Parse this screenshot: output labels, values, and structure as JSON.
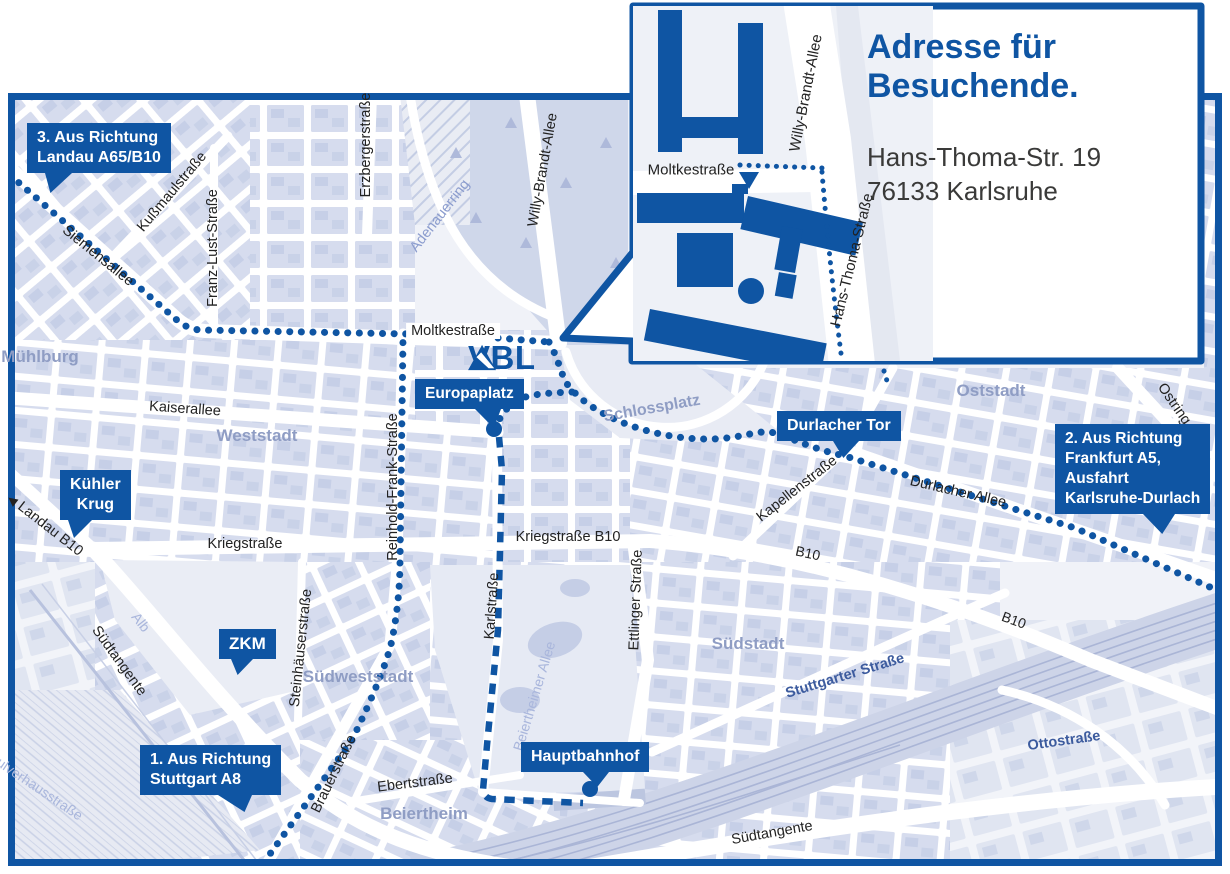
{
  "colors": {
    "primary_blue": "#0f55a3",
    "district_gray": "#8f9dc4",
    "light_street_blue": "#a9b6dc",
    "street_text": "#222222",
    "address_gray": "#3a3a39",
    "map_block": "#d6dcee",
    "street_white": "#ffffff"
  },
  "logo": {
    "name": "VBL"
  },
  "inset": {
    "title_line1": "Adresse für",
    "title_line2": "Besuchende.",
    "address_line1": "Hans-Thoma-Str. 19",
    "address_line2": "76133 Karlsruhe",
    "street_moltke": "Moltkestraße",
    "street_willy": "Willy-Brandt-Allee",
    "street_hans_thoma": "Hans-Thoma-Straße"
  },
  "callouts": {
    "landau": {
      "line1": "3. Aus Richtung",
      "line2": "Landau A65/B10"
    },
    "frankfurt": {
      "line1": "2. Aus Richtung",
      "line2": "Frankfurt A5,",
      "line3": "Ausfahrt",
      "line4": "Karlsruhe-Durlach"
    },
    "stuttgart": {
      "line1": "1. Aus Richtung",
      "line2": "Stuttgart A8"
    },
    "kuehler_krug": {
      "line1": "Kühler",
      "line2": "Krug"
    },
    "zkm": {
      "label": "ZKM"
    },
    "europaplatz": {
      "label": "Europaplatz"
    },
    "durlacher_tor": {
      "label": "Durlacher Tor"
    },
    "hauptbahnhof": {
      "label": "Hauptbahnhof"
    }
  },
  "districts": {
    "muehlburg": "Mühlburg",
    "weststadt": "Weststadt",
    "oststadt": "Oststadt",
    "suedstadt": "Südstadt",
    "suedweststadt": "Südweststadt",
    "beiertheim": "Beiertheim",
    "schlossplatz": "Schlossplatz"
  },
  "streets": {
    "moltkestrasse": "Moltkestraße",
    "kaiserallee": "Kaiserallee",
    "kriegstrasse": "Kriegstraße",
    "kriegstrasse_b10": "Kriegstraße B10",
    "siemensallee": "Siemensallee",
    "kussmaulstrasse": "Kußmaulstraße",
    "franz_lust_strasse": "Franz-Lust-Straße",
    "erzbergerstrasse": "Erzbergerstraße",
    "adenauerring": "Adenauerring",
    "willy_brandt_allee": "Willy-Brandt-Allee",
    "reinhold_frank_strasse": "Reinhold-Frank-Straße",
    "karlstrasse": "Karlstraße",
    "ettlinger_strasse": "Ettlinger Straße",
    "steinhaeuserstrasse": "Steinhäuserstraße",
    "brauerstrasse": "Brauerstraße",
    "ebertstrasse": "Ebertstraße",
    "durlacher_allee": "Durlacher Allee",
    "kapellenstrasse": "Kapellenstraße",
    "ostring": "Ostring",
    "stuttgarter_strasse": "Stuttgarter Straße",
    "ottostrasse": "Ottostraße",
    "suedtangente": "Südtangente",
    "landau_b10": "Landau B10",
    "b10": "B10",
    "alb": "Alb",
    "pulverhausstrasse": "Pulverhausstraße",
    "beiertheimer_allee": "Beiertheimer Allee"
  },
  "icons": {
    "west_arrow": "◀"
  }
}
